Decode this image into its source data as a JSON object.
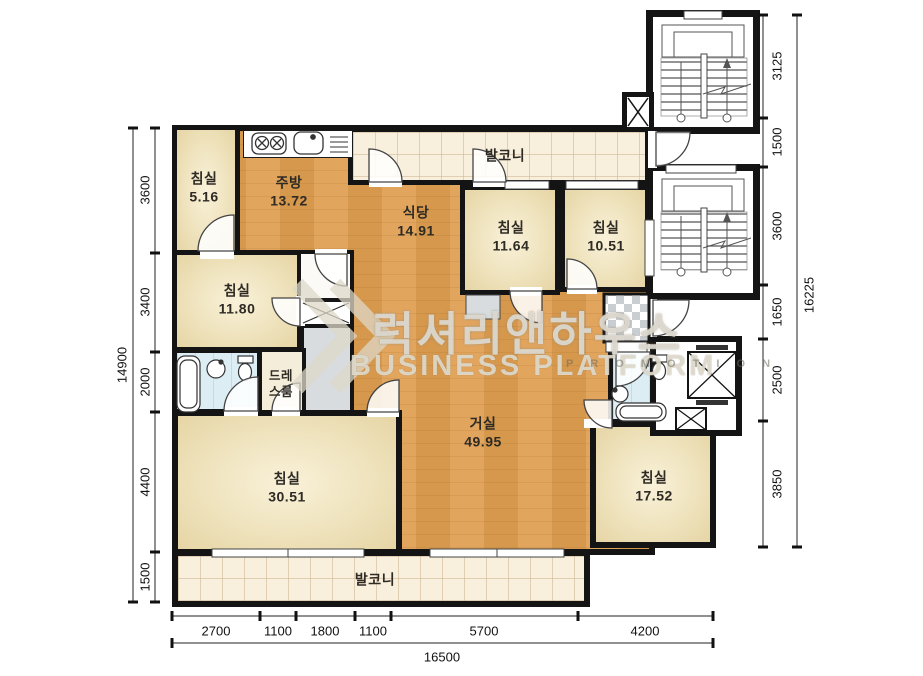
{
  "rooms": {
    "bedroom_516": {
      "label": "침실",
      "area": "5.16"
    },
    "kitchen": {
      "label": "주방",
      "area": "13.72"
    },
    "dining": {
      "label": "식당",
      "area": "14.91"
    },
    "balcony_top": {
      "label": "발코니"
    },
    "bedroom_1164": {
      "label": "침실",
      "area": "11.64"
    },
    "bedroom_1051": {
      "label": "침실",
      "area": "10.51"
    },
    "bedroom_1180": {
      "label": "침실",
      "area": "11.80"
    },
    "dress_room": {
      "label": "드레스룸"
    },
    "living": {
      "label": "거실",
      "area": "49.95"
    },
    "bedroom_3051": {
      "label": "침실",
      "area": "30.51"
    },
    "bedroom_1752": {
      "label": "침실",
      "area": "17.52"
    },
    "balcony_bottom": {
      "label": "발코니"
    }
  },
  "dimensions": {
    "left": [
      "3600",
      "3400",
      "2000",
      "4400",
      "1500"
    ],
    "left_total": "14900",
    "right": [
      "3125",
      "1500",
      "3600",
      "1650",
      "2500",
      "3850"
    ],
    "right_total": "16225",
    "bottom": [
      "2700",
      "1100",
      "1800",
      "1100",
      "5700",
      "4200"
    ],
    "bottom_total": "16500"
  },
  "watermark": {
    "korean": "럭셔리앤하우스",
    "english": "BUSINESS PLATFORM",
    "promo": "P R O M O T I O N"
  },
  "colors": {
    "wall": "#141414",
    "wood_floor": "#dfa35c",
    "bedroom_cream": "#f2e7c3",
    "balcony_tile": "#f8efdd",
    "bathroom_blue": "#dcedf4",
    "closet_gray": "#d8dcdf"
  }
}
